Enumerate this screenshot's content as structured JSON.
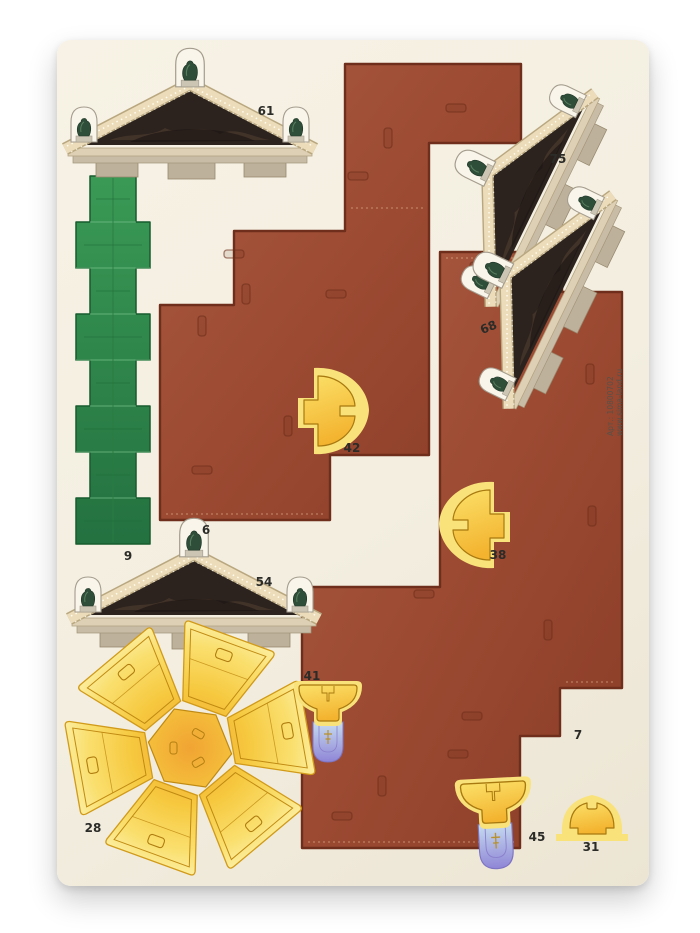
{
  "sheet": {
    "description": "papercraft die-cut parts sheet, cathedral model",
    "background_color": "#f3eee0",
    "page_background": "#ffffff"
  },
  "branding": {
    "article": "Арт.: 10800702",
    "website": "www.sima-land.ru"
  },
  "pieces": {
    "p6": {
      "label": "6",
      "kind": "roof-panel-stepped"
    },
    "p7": {
      "label": "7",
      "kind": "roof-panel-stepped"
    },
    "p9": {
      "label": "9",
      "kind": "green-castellated-strip"
    },
    "p28": {
      "label": "28",
      "kind": "dome-petal-rosette"
    },
    "p31": {
      "label": "31",
      "kind": "small-dome-gore"
    },
    "p38": {
      "label": "38",
      "kind": "dome-gore"
    },
    "p41": {
      "label": "41",
      "kind": "cupola-with-lantern"
    },
    "p42": {
      "label": "42",
      "kind": "dome-gore"
    },
    "p45": {
      "label": "45",
      "kind": "cupola-with-lantern"
    },
    "p54": {
      "label": "54",
      "kind": "pediment-with-statues"
    },
    "p61": {
      "label": "61",
      "kind": "pediment-with-statues"
    },
    "p68": {
      "label": "68",
      "kind": "pediment-with-statues-rotated"
    },
    "p75": {
      "label": "75",
      "kind": "pediment-with-statues-rotated"
    }
  },
  "palette": {
    "roof_brown": "#9c4a32",
    "roof_edge": "#6e2e1b",
    "strip_green": "#2e8c4b",
    "gold": "#f7cf3f",
    "gold_pale": "#f9e27a",
    "gold_deep": "#eda32c",
    "cornice_cream": "#ecdcba",
    "tympanum_dark": "#2c231e",
    "statue_green": "#2f4e39",
    "stone_grey": "#beb19b",
    "lantern_violet": "#8f85d6",
    "lantern_blue": "#c2d9ef",
    "label_ink": "#2b2b28"
  }
}
